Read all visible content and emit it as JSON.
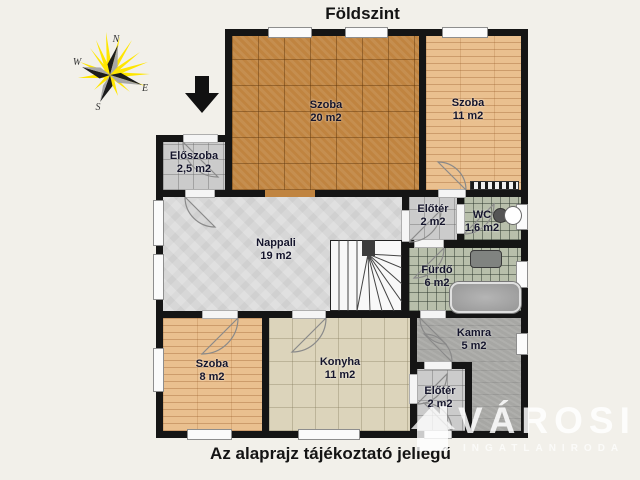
{
  "title": "Földszint",
  "disclaimer": "Az alaprajz tájékoztató jellegű",
  "compass": {
    "north": "N",
    "west": "W",
    "east": "E",
    "south": "S"
  },
  "watermark": {
    "brand": "VÁROSI",
    "tagline": "INGATLANIRODA"
  },
  "rooms": [
    {
      "name": "Szoba",
      "area": "20 m2"
    },
    {
      "name": "Szoba",
      "area": "11 m2"
    },
    {
      "name": "Előszoba",
      "area": "2,5 m2"
    },
    {
      "name": "Nappali",
      "area": "19 m2"
    },
    {
      "name": "Előtér",
      "area": "2 m2"
    },
    {
      "name": "WC",
      "area": "1,6 m2"
    },
    {
      "name": "Fürdő",
      "area": "6 m2"
    },
    {
      "name": "Kamra",
      "area": "5 m2"
    },
    {
      "name": "Szoba",
      "area": "8 m2"
    },
    {
      "name": "Konyha",
      "area": "11 m2"
    },
    {
      "name": "Előtér",
      "area": "2 m2"
    }
  ],
  "colors": {
    "bg": "#f2f0ea",
    "wall": "#151515",
    "parquet": "#c08440",
    "plank": "#eac08f",
    "stone": "#d7d7d7",
    "tile-gray": "#cbcbcb",
    "tile-beige": "#dcd4bb",
    "tile-bath": "#b8bfab",
    "pantry": "#a7a7a4",
    "label": "#15152c",
    "sun": "#ffe600"
  }
}
